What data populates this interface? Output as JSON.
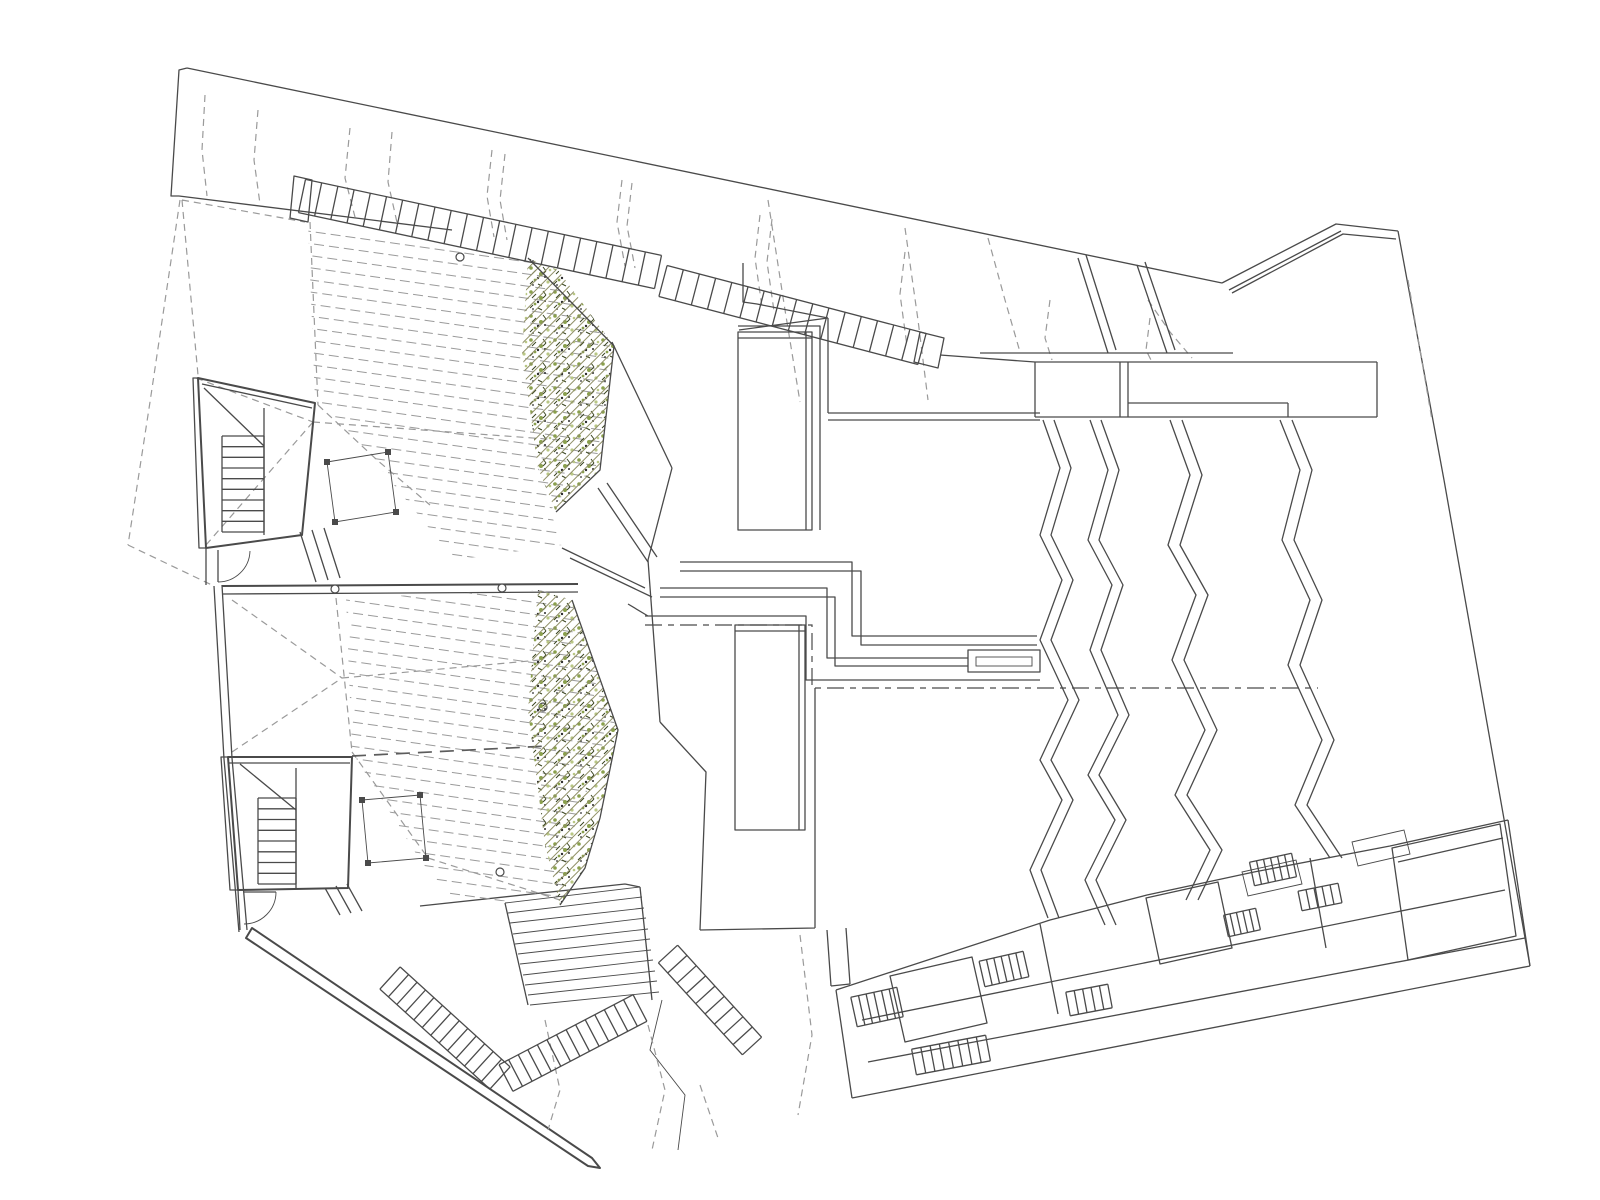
{
  "canvas": {
    "width": 1600,
    "height": 1200
  },
  "drawing": {
    "type": "architectural-site-plan",
    "visible_text": [],
    "features": [
      "site-boundary",
      "contour-lines",
      "long-top-staircase",
      "upper-terrace-deck",
      "lower-terrace-deck",
      "upper-planter-band",
      "lower-planter-band",
      "upper-stair-block",
      "lower-stair-block",
      "central-walkway",
      "skylights",
      "roof-fold-lines",
      "amphitheater-steps",
      "patio-band-with-stairs",
      "retaining-walls"
    ]
  },
  "colors": {
    "background": "#ffffff",
    "line": "#4a4a4a",
    "dash": "#9a9a9a",
    "vegetation": "#8aa04c",
    "vegetation_light": "#b9c784",
    "vegetation_dark": "#39441f"
  }
}
